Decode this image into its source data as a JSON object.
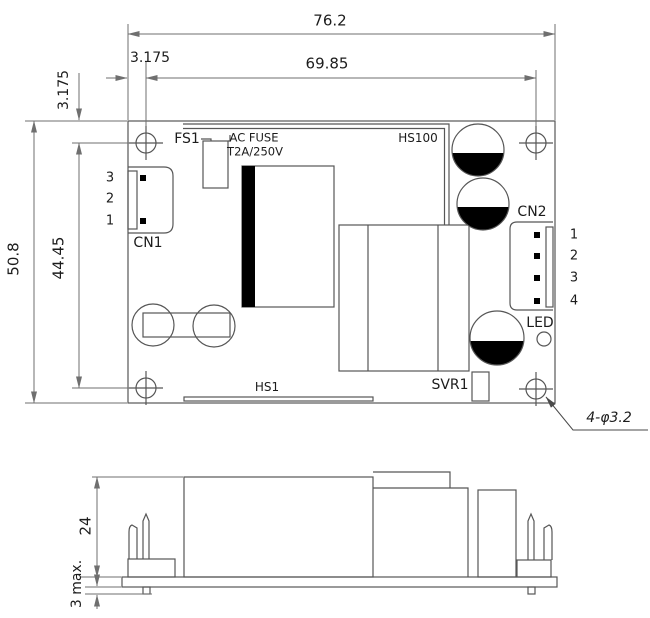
{
  "top_view": {
    "dims": {
      "total_width": "76.2",
      "hole_width": "69.85",
      "edge_offset_x": "3.175",
      "edge_offset_y": "3.175",
      "total_height": "50.8",
      "hole_height": "44.45",
      "hole_spec": "4-φ3.2"
    },
    "labels": {
      "fuse_ref": "FS1",
      "fuse_type": "AC FUSE",
      "fuse_rating": "T2A/250V",
      "heatsink_right": "HS100",
      "heatsink_bottom": "HS1",
      "input_conn": "CN1",
      "output_conn": "CN2",
      "led": "LED",
      "trimmer": "SVR1"
    },
    "cn1_pins": [
      "3",
      "2",
      "1"
    ],
    "cn2_pins": [
      "1",
      "2",
      "3",
      "4"
    ]
  },
  "side_view": {
    "dims": {
      "component_height": "24",
      "pin_protrusion": "3 max."
    }
  },
  "colors": {
    "part_line": "#565656",
    "dim_line": "#6f6f6f",
    "fill_black": "#000000"
  }
}
